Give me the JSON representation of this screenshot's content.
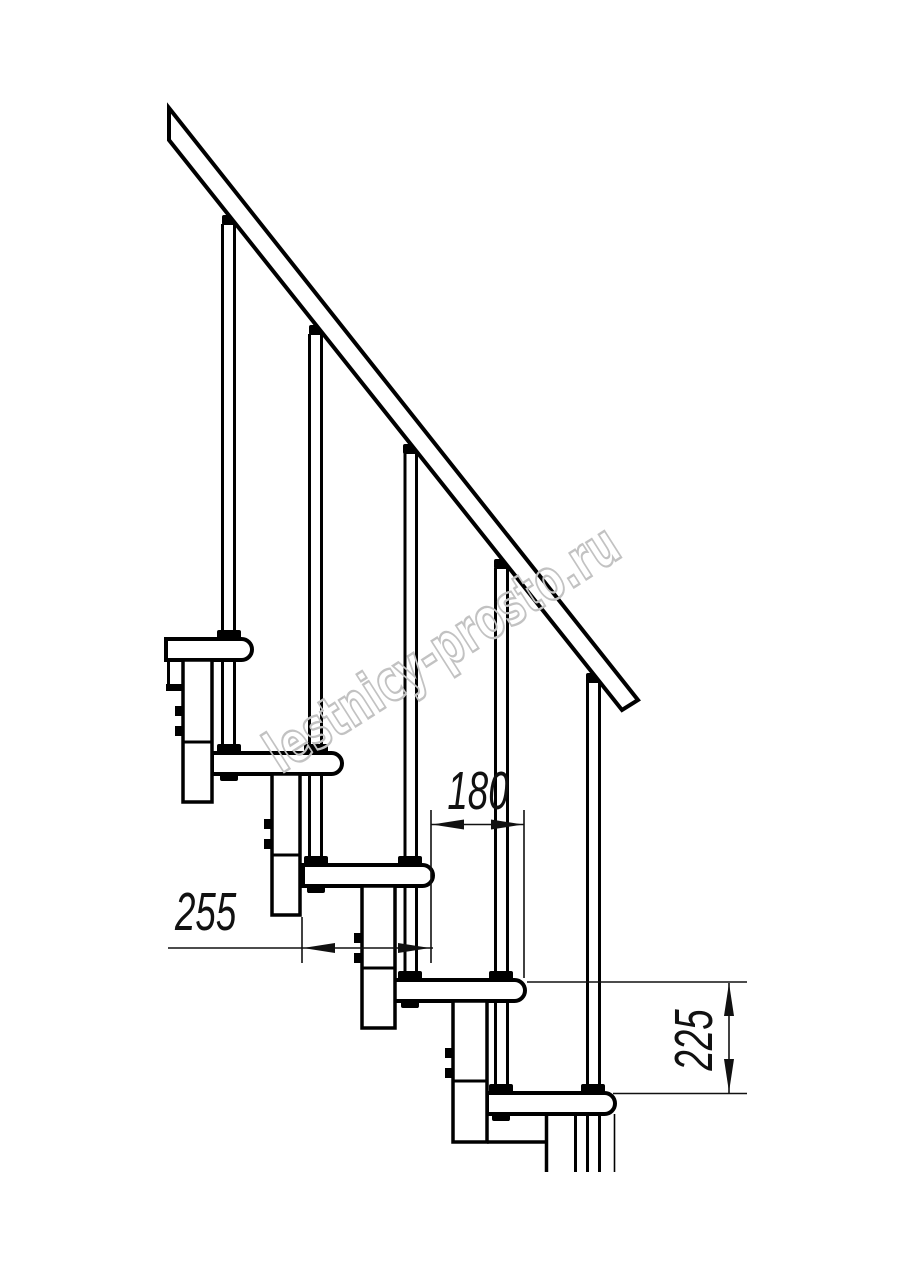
{
  "drawing": {
    "type": "stair-side-elevation",
    "dimensions": {
      "step_run": {
        "value": "180"
      },
      "tread_depth": {
        "value": "255"
      },
      "step_rise": {
        "value": "225"
      }
    }
  },
  "watermark": {
    "text": "lestnicy-prosto.ru",
    "color": "#c2c2c2"
  },
  "colors": {
    "ink": "#000000",
    "paper": "#ffffff",
    "dimension": "#111111"
  }
}
